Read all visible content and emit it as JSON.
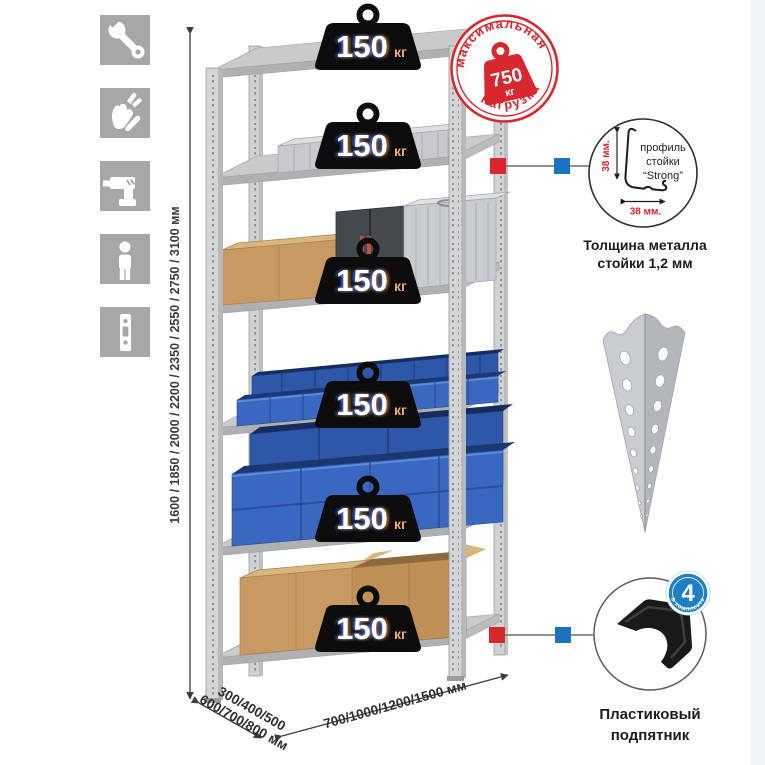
{
  "sidebar": {
    "icons": [
      "wrench-icon",
      "gloves-icon",
      "drill-icon",
      "person-icon",
      "rack-post-icon"
    ]
  },
  "dims": {
    "height": "1600 / 1850 / 2000 / 2200 / 2350 / 2550 / 2750 / 3100 мм",
    "depth1": "300/400/500",
    "depth2": "600/700/800 мм",
    "width": "700/1000/1200/1500 мм"
  },
  "badges": [
    {
      "value": "150",
      "unit": "кг"
    },
    {
      "value": "150",
      "unit": "кг"
    },
    {
      "value": "150",
      "unit": "кг"
    },
    {
      "value": "150",
      "unit": "кг"
    },
    {
      "value": "150",
      "unit": "кг"
    },
    {
      "value": "150",
      "unit": "кг"
    }
  ],
  "stamp": {
    "top_text": "максимальная",
    "bottom_text": "нагрузка",
    "weight_value": "750",
    "weight_unit": "кг"
  },
  "profile": {
    "line1": "профиль",
    "line2": "стойки",
    "line3": "“Strong”",
    "dim_v": "38 мм.",
    "dim_h": "38 мм.",
    "caption1": "Толщина металла",
    "caption2": "стойки 1,2 мм"
  },
  "foot": {
    "count": "4",
    "ring_text": "в комплекте",
    "caption1": "Пластиковый",
    "caption2": "подпятник"
  },
  "colors": {
    "accent_red": "#d7282f",
    "accent_blue": "#1a72c0",
    "bin_blue": "#3a68c0",
    "metal_gray": "#d3d5d7",
    "icon_gray": "#a7a7a7"
  }
}
